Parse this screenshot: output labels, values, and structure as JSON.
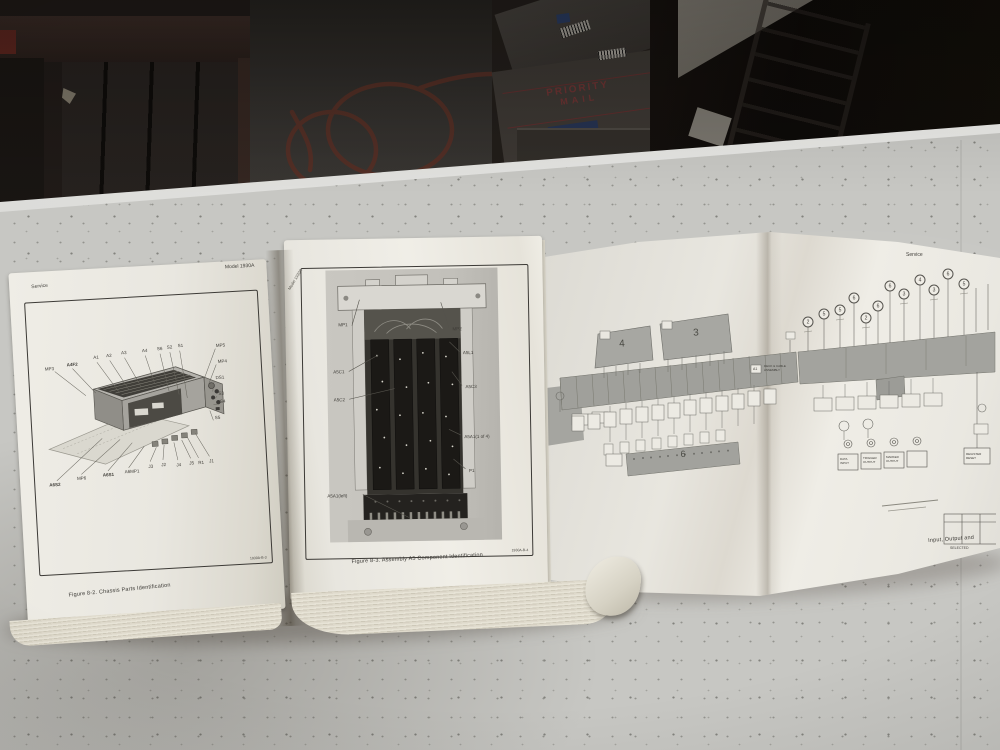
{
  "left_page": {
    "header_left": "Service",
    "header_right": "Model 1930A",
    "figure_code": "1930A-B-3",
    "caption": "Figure 8-2. Chassis Parts Identification",
    "callouts_top": [
      "A1",
      "A2",
      "A3",
      "A4",
      "S6",
      "S2",
      "S1"
    ],
    "callouts_right": [
      "MP5",
      "MP4",
      "DS1",
      "S3",
      "S4",
      "S5"
    ],
    "callouts_left": [
      "MP3",
      "A4F2"
    ],
    "callouts_bottom": [
      "A6S2",
      "MP6",
      "A6S1",
      "A6MP1",
      "J3",
      "J2",
      "J4",
      "J5",
      "R1",
      "J1"
    ]
  },
  "middle_page": {
    "header_top": "Model 1930A",
    "figure_code": "1930A-B-4",
    "caption": "Figure 8-3. Assembly A5 Component Identification",
    "callouts_left": [
      "MP1",
      "A5C1",
      "A5C2",
      "A5A1(left)"
    ],
    "callouts_right": [
      "MP2",
      "A5L1",
      "A5C3",
      "A5A1(1 of 4)",
      "P1"
    ]
  },
  "foldout": {
    "header_right": "Service",
    "block_4": "4",
    "block_3": "3",
    "bar_6": "6",
    "ref_a1": "A1",
    "a1_label_line1": "DECK & CABLE",
    "a1_label_line2": "ASSEMBLY",
    "circled_numbers": [
      "2",
      "5",
      "5",
      "6",
      "2",
      "6",
      "6",
      "3",
      "4",
      "3",
      "6",
      "5"
    ],
    "io_box_1_line1": "DATA",
    "io_box_1_line2": "INPUT",
    "io_box_2_line1": "TRIGGER",
    "io_box_2_line2": "OUTPUT",
    "io_box_3_line1": "MARKER",
    "io_box_3_line2": "OUTPUT",
    "reset_box_line1": "REGISTER",
    "reset_box_line2": "RESET",
    "table_note": "SELECTED",
    "bottom_caption": "Input, Output and"
  },
  "background": {
    "box_text_line1": "PRIORITY",
    "box_text_line2": "MAIL"
  }
}
